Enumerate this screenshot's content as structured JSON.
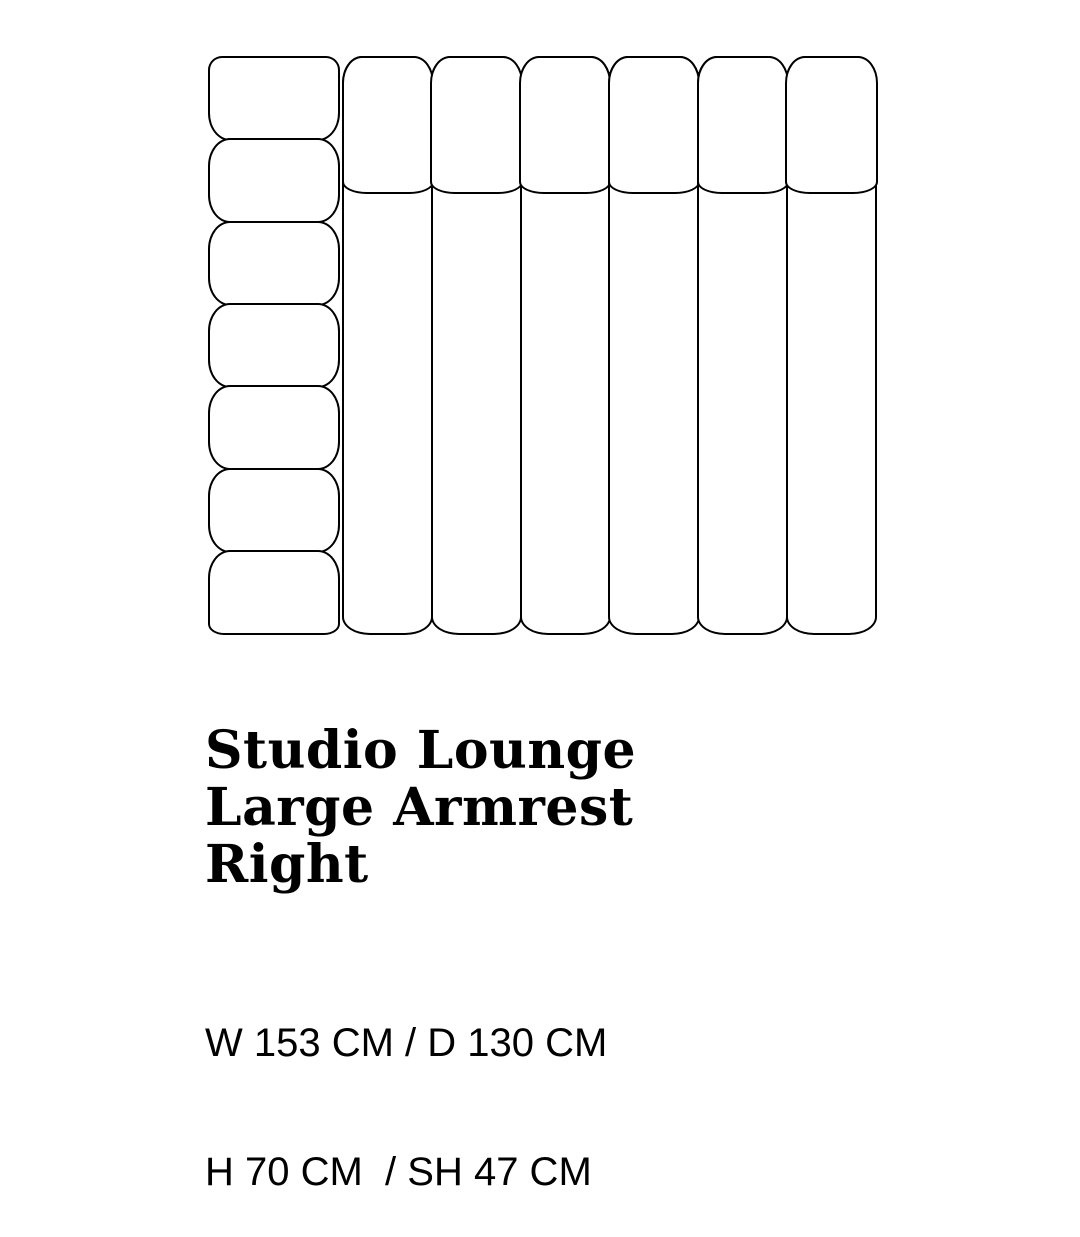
{
  "product": {
    "title": "Studio Lounge\nLarge Armrest\nRight",
    "dimensions": {
      "line1": "W 153 CM / D 130 CM",
      "line2": "H 70 CM  / SH 47 CM"
    }
  },
  "diagram": {
    "armrest_segments": 7,
    "seat_channels": 6,
    "backrest_cushions": 6,
    "line_color": "#000000",
    "background_color": "#ffffff"
  }
}
